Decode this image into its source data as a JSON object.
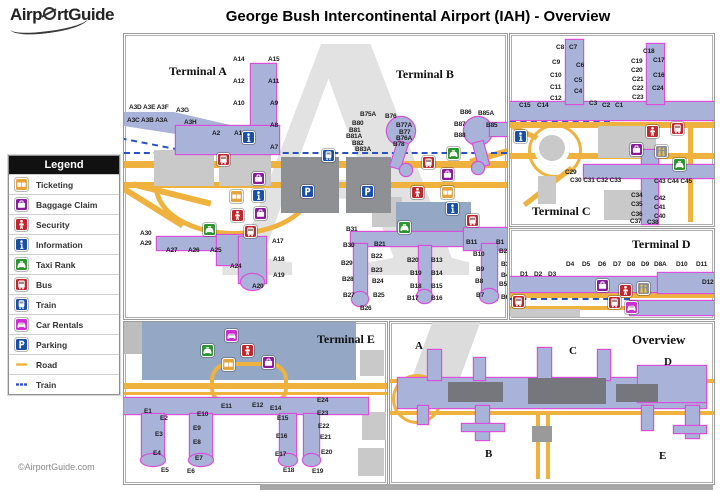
{
  "header": {
    "logo_part1": "Airp",
    "logo_part2": "rtGuide",
    "title": "George Bush Intercontinental Airport (IAH) - Overview"
  },
  "footer": {
    "copyright": "©AirportGuide.com"
  },
  "colors": {
    "road": "#f0b23e",
    "train_line": "#2a52c8",
    "terminal_fill": "#a9b3d9",
    "terminal_outline": "#d94fd9",
    "icons": {
      "ticketing": "#e8a33d",
      "baggage-claim": "#8a1c9c",
      "security": "#c4262c",
      "information": "#1a4fa8",
      "taxi": "#2e9431",
      "bus": "#c4262c",
      "train": "#1a4fa8",
      "car-rentals": "#cb2fd1",
      "parking": "#1a4fa8",
      "assistance": "#8a8f96"
    }
  },
  "legend": {
    "title": "Legend",
    "items": [
      {
        "label": "Ticketing",
        "type": "ticketing"
      },
      {
        "label": "Baggage Claim",
        "type": "baggage-claim"
      },
      {
        "label": "Security",
        "type": "security"
      },
      {
        "label": "Information",
        "type": "information"
      },
      {
        "label": "Taxi Rank",
        "type": "taxi"
      },
      {
        "label": "Bus",
        "type": "bus"
      },
      {
        "label": "Train",
        "type": "train"
      },
      {
        "label": "Car Rentals",
        "type": "car-rentals"
      },
      {
        "label": "Parking",
        "type": "parking"
      },
      {
        "label": "Road",
        "type": "road"
      },
      {
        "label": "Train",
        "type": "train-line"
      }
    ]
  },
  "panels": {
    "ab": {
      "label_terminal_a": "Terminal A",
      "label_terminal_b": "Terminal B",
      "watermark": "A",
      "gates": [
        {
          "t": "A14",
          "x": 109,
          "y": 22
        },
        {
          "t": "A15",
          "x": 144,
          "y": 22
        },
        {
          "t": "A12",
          "x": 109,
          "y": 44
        },
        {
          "t": "A11",
          "x": 144,
          "y": 44
        },
        {
          "t": "A10",
          "x": 109,
          "y": 66
        },
        {
          "t": "A9",
          "x": 146,
          "y": 66
        },
        {
          "t": "A8",
          "x": 146,
          "y": 88
        },
        {
          "t": "A7",
          "x": 146,
          "y": 110
        },
        {
          "t": "A3D A3E A3F",
          "x": 5,
          "y": 70
        },
        {
          "t": "A3G",
          "x": 52,
          "y": 73
        },
        {
          "t": "A3C A3B A3A",
          "x": 3,
          "y": 83
        },
        {
          "t": "A3H",
          "x": 60,
          "y": 85
        },
        {
          "t": "A2",
          "x": 88,
          "y": 96
        },
        {
          "t": "A1",
          "x": 110,
          "y": 96
        },
        {
          "t": "A30",
          "x": 16,
          "y": 196
        },
        {
          "t": "A29",
          "x": 16,
          "y": 206
        },
        {
          "t": "A27",
          "x": 42,
          "y": 213
        },
        {
          "t": "A26",
          "x": 64,
          "y": 213
        },
        {
          "t": "A25",
          "x": 86,
          "y": 213
        },
        {
          "t": "A24",
          "x": 106,
          "y": 229
        },
        {
          "t": "A20",
          "x": 128,
          "y": 249
        },
        {
          "t": "A17",
          "x": 148,
          "y": 204
        },
        {
          "t": "A18",
          "x": 149,
          "y": 222
        },
        {
          "t": "A19",
          "x": 149,
          "y": 238
        },
        {
          "t": "B75A",
          "x": 236,
          "y": 77
        },
        {
          "t": "B76",
          "x": 261,
          "y": 79
        },
        {
          "t": "B80",
          "x": 228,
          "y": 86
        },
        {
          "t": "B81",
          "x": 225,
          "y": 93
        },
        {
          "t": "B81A",
          "x": 222,
          "y": 99
        },
        {
          "t": "B82",
          "x": 228,
          "y": 106
        },
        {
          "t": "B83A",
          "x": 231,
          "y": 112
        },
        {
          "t": "B77A",
          "x": 272,
          "y": 88
        },
        {
          "t": "B77",
          "x": 275,
          "y": 95
        },
        {
          "t": "B76A",
          "x": 272,
          "y": 101
        },
        {
          "t": "B78",
          "x": 269,
          "y": 107
        },
        {
          "t": "B86",
          "x": 336,
          "y": 75
        },
        {
          "t": "B85A",
          "x": 354,
          "y": 76
        },
        {
          "t": "B87",
          "x": 330,
          "y": 87
        },
        {
          "t": "B88",
          "x": 330,
          "y": 98
        },
        {
          "t": "B85",
          "x": 362,
          "y": 88
        },
        {
          "t": "B31",
          "x": 222,
          "y": 192
        },
        {
          "t": "B30",
          "x": 219,
          "y": 208
        },
        {
          "t": "B29",
          "x": 217,
          "y": 226
        },
        {
          "t": "B28",
          "x": 218,
          "y": 242
        },
        {
          "t": "B27",
          "x": 219,
          "y": 258
        },
        {
          "t": "B21",
          "x": 250,
          "y": 207
        },
        {
          "t": "B22",
          "x": 247,
          "y": 219
        },
        {
          "t": "B23",
          "x": 247,
          "y": 233
        },
        {
          "t": "B24",
          "x": 248,
          "y": 244
        },
        {
          "t": "B25",
          "x": 249,
          "y": 258
        },
        {
          "t": "B26",
          "x": 236,
          "y": 271
        },
        {
          "t": "B20",
          "x": 283,
          "y": 223
        },
        {
          "t": "B13",
          "x": 307,
          "y": 223
        },
        {
          "t": "B19",
          "x": 286,
          "y": 236
        },
        {
          "t": "B14",
          "x": 307,
          "y": 236
        },
        {
          "t": "B18",
          "x": 286,
          "y": 249
        },
        {
          "t": "B15",
          "x": 307,
          "y": 249
        },
        {
          "t": "B17",
          "x": 283,
          "y": 261
        },
        {
          "t": "B16",
          "x": 307,
          "y": 261
        },
        {
          "t": "B11",
          "x": 342,
          "y": 205
        },
        {
          "t": "B10",
          "x": 349,
          "y": 217
        },
        {
          "t": "B9",
          "x": 352,
          "y": 232
        },
        {
          "t": "B8",
          "x": 351,
          "y": 244
        },
        {
          "t": "B7",
          "x": 352,
          "y": 258
        },
        {
          "t": "B1",
          "x": 372,
          "y": 205
        },
        {
          "t": "B2",
          "x": 375,
          "y": 214
        },
        {
          "t": "B3",
          "x": 377,
          "y": 227
        },
        {
          "t": "B4",
          "x": 377,
          "y": 238
        },
        {
          "t": "B5",
          "x": 375,
          "y": 247
        },
        {
          "t": "B6",
          "x": 377,
          "y": 260
        }
      ],
      "icons": [
        {
          "type": "information",
          "x": 118,
          "y": 97
        },
        {
          "type": "bus",
          "x": 93,
          "y": 119
        },
        {
          "type": "baggage-claim",
          "x": 128,
          "y": 138
        },
        {
          "type": "ticketing",
          "x": 106,
          "y": 156
        },
        {
          "type": "information",
          "x": 128,
          "y": 155
        },
        {
          "type": "security",
          "x": 107,
          "y": 175
        },
        {
          "type": "baggage-claim",
          "x": 130,
          "y": 173
        },
        {
          "type": "taxi",
          "x": 79,
          "y": 189
        },
        {
          "type": "bus",
          "x": 120,
          "y": 191
        },
        {
          "type": "parking",
          "x": 177,
          "y": 151
        },
        {
          "type": "parking",
          "x": 237,
          "y": 151
        },
        {
          "type": "train",
          "x": 198,
          "y": 115
        },
        {
          "type": "taxi",
          "x": 323,
          "y": 113
        },
        {
          "type": "bus",
          "x": 298,
          "y": 122
        },
        {
          "type": "baggage-claim",
          "x": 317,
          "y": 134
        },
        {
          "type": "security",
          "x": 287,
          "y": 152
        },
        {
          "type": "ticketing",
          "x": 317,
          "y": 152
        },
        {
          "type": "information",
          "x": 322,
          "y": 168
        },
        {
          "type": "bus",
          "x": 342,
          "y": 180
        },
        {
          "type": "taxi",
          "x": 274,
          "y": 187
        }
      ]
    },
    "c": {
      "label": "Terminal C",
      "gates": [
        {
          "t": "C8",
          "x": 46,
          "y": 10
        },
        {
          "t": "C7",
          "x": 59,
          "y": 10
        },
        {
          "t": "C9",
          "x": 42,
          "y": 25
        },
        {
          "t": "C6",
          "x": 66,
          "y": 28
        },
        {
          "t": "C10",
          "x": 40,
          "y": 38
        },
        {
          "t": "C5",
          "x": 64,
          "y": 43
        },
        {
          "t": "C11",
          "x": 40,
          "y": 50
        },
        {
          "t": "C4",
          "x": 64,
          "y": 54
        },
        {
          "t": "C12",
          "x": 40,
          "y": 61
        },
        {
          "t": "C15",
          "x": 9,
          "y": 68
        },
        {
          "t": "C14",
          "x": 27,
          "y": 68
        },
        {
          "t": "C3",
          "x": 79,
          "y": 66
        },
        {
          "t": "C2",
          "x": 92,
          "y": 68
        },
        {
          "t": "C1",
          "x": 105,
          "y": 68
        },
        {
          "t": "C18",
          "x": 133,
          "y": 14
        },
        {
          "t": "C19",
          "x": 121,
          "y": 24
        },
        {
          "t": "C17",
          "x": 143,
          "y": 23
        },
        {
          "t": "C20",
          "x": 121,
          "y": 33
        },
        {
          "t": "C16",
          "x": 143,
          "y": 38
        },
        {
          "t": "C21",
          "x": 122,
          "y": 42
        },
        {
          "t": "C22",
          "x": 122,
          "y": 51
        },
        {
          "t": "C24",
          "x": 142,
          "y": 51
        },
        {
          "t": "C23",
          "x": 122,
          "y": 60
        },
        {
          "t": "C29",
          "x": 55,
          "y": 135
        },
        {
          "t": "C30 C31 C32 C33",
          "x": 60,
          "y": 143
        },
        {
          "t": "C43 C44 C45",
          "x": 144,
          "y": 144
        },
        {
          "t": "C34",
          "x": 121,
          "y": 158
        },
        {
          "t": "C42",
          "x": 144,
          "y": 161
        },
        {
          "t": "C35",
          "x": 121,
          "y": 167
        },
        {
          "t": "C41",
          "x": 144,
          "y": 170
        },
        {
          "t": "C36",
          "x": 121,
          "y": 177
        },
        {
          "t": "C40",
          "x": 144,
          "y": 179
        },
        {
          "t": "C37",
          "x": 120,
          "y": 184
        },
        {
          "t": "C38",
          "x": 137,
          "y": 185
        }
      ],
      "icons": [
        {
          "type": "information",
          "x": 4,
          "y": 96
        },
        {
          "type": "security",
          "x": 136,
          "y": 91
        },
        {
          "type": "bus",
          "x": 161,
          "y": 88
        },
        {
          "type": "baggage-claim",
          "x": 120,
          "y": 109
        },
        {
          "type": "assistance",
          "x": 145,
          "y": 111
        },
        {
          "type": "taxi",
          "x": 163,
          "y": 124
        }
      ]
    },
    "d": {
      "label": "Terminal D",
      "gates": [
        {
          "t": "D1",
          "x": 10,
          "y": 42
        },
        {
          "t": "D2",
          "x": 24,
          "y": 42
        },
        {
          "t": "D3",
          "x": 38,
          "y": 42
        },
        {
          "t": "D4",
          "x": 56,
          "y": 32
        },
        {
          "t": "D5",
          "x": 72,
          "y": 32
        },
        {
          "t": "D6",
          "x": 88,
          "y": 32
        },
        {
          "t": "D7",
          "x": 103,
          "y": 32
        },
        {
          "t": "D8",
          "x": 117,
          "y": 32
        },
        {
          "t": "D9",
          "x": 131,
          "y": 32
        },
        {
          "t": "D8A",
          "x": 144,
          "y": 32
        },
        {
          "t": "D10",
          "x": 166,
          "y": 32
        },
        {
          "t": "D11",
          "x": 186,
          "y": 32
        },
        {
          "t": "D12",
          "x": 192,
          "y": 50
        }
      ],
      "icons": [
        {
          "type": "baggage-claim",
          "x": 86,
          "y": 50
        },
        {
          "type": "security",
          "x": 109,
          "y": 55
        },
        {
          "type": "assistance",
          "x": 127,
          "y": 53
        },
        {
          "type": "bus",
          "x": 98,
          "y": 67
        },
        {
          "type": "car-rentals",
          "x": 115,
          "y": 72
        },
        {
          "type": "bus",
          "x": 2,
          "y": 66
        }
      ]
    },
    "e": {
      "label": "Terminal E",
      "gates": [
        {
          "t": "E1",
          "x": 20,
          "y": 86
        },
        {
          "t": "E2",
          "x": 36,
          "y": 93
        },
        {
          "t": "E3",
          "x": 31,
          "y": 109
        },
        {
          "t": "E4",
          "x": 29,
          "y": 128
        },
        {
          "t": "E5",
          "x": 37,
          "y": 145
        },
        {
          "t": "E6",
          "x": 63,
          "y": 146
        },
        {
          "t": "E7",
          "x": 71,
          "y": 133
        },
        {
          "t": "E8",
          "x": 69,
          "y": 117
        },
        {
          "t": "E9",
          "x": 69,
          "y": 103
        },
        {
          "t": "E10",
          "x": 73,
          "y": 89
        },
        {
          "t": "E11",
          "x": 97,
          "y": 81
        },
        {
          "t": "E12",
          "x": 128,
          "y": 80
        },
        {
          "t": "E14",
          "x": 146,
          "y": 83
        },
        {
          "t": "E15",
          "x": 153,
          "y": 93
        },
        {
          "t": "E16",
          "x": 152,
          "y": 111
        },
        {
          "t": "E17",
          "x": 151,
          "y": 129
        },
        {
          "t": "E18",
          "x": 159,
          "y": 145
        },
        {
          "t": "E19",
          "x": 188,
          "y": 146
        },
        {
          "t": "E20",
          "x": 197,
          "y": 127
        },
        {
          "t": "E21",
          "x": 196,
          "y": 112
        },
        {
          "t": "E22",
          "x": 194,
          "y": 101
        },
        {
          "t": "E23",
          "x": 193,
          "y": 88
        },
        {
          "t": "E24",
          "x": 193,
          "y": 75
        }
      ],
      "icons": [
        {
          "type": "taxi",
          "x": 77,
          "y": 22
        },
        {
          "type": "car-rentals",
          "x": 101,
          "y": 7
        },
        {
          "type": "security",
          "x": 117,
          "y": 22
        },
        {
          "type": "ticketing",
          "x": 98,
          "y": 36
        },
        {
          "type": "baggage-claim",
          "x": 138,
          "y": 34
        }
      ]
    },
    "overview": {
      "label": "Overview",
      "letters": [
        {
          "t": "A",
          "x": 25,
          "y": 18
        },
        {
          "t": "C",
          "x": 179,
          "y": 23
        },
        {
          "t": "D",
          "x": 274,
          "y": 34
        },
        {
          "t": "B",
          "x": 95,
          "y": 126
        },
        {
          "t": "E",
          "x": 269,
          "y": 128
        }
      ]
    }
  }
}
